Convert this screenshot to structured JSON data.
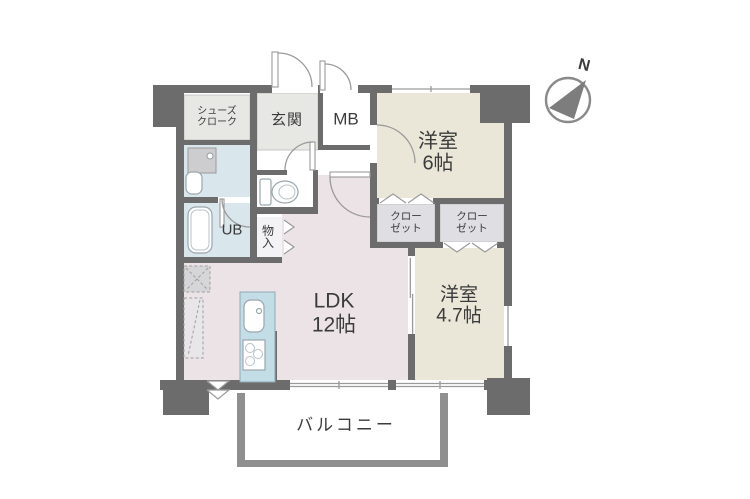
{
  "figure": {
    "kind": "apartment-floor-plan"
  },
  "compass": {
    "label": "N"
  },
  "rooms": {
    "shoes_closet": {
      "label": "シューズ\nクローク"
    },
    "entrance": {
      "label": "玄関"
    },
    "meter_box": {
      "label": "MB"
    },
    "bedroom_6": {
      "label": "洋室\n6帖"
    },
    "closet_a": {
      "label": "クロー\nゼット"
    },
    "closet_b": {
      "label": "クロー\nゼット"
    },
    "unit_bath": {
      "label": "UB"
    },
    "storage": {
      "label": "物\n入"
    },
    "ldk": {
      "label": "LDK\n12帖"
    },
    "bedroom_47": {
      "label": "洋室\n4.7帖"
    },
    "balcony": {
      "label": "バルコニー"
    }
  },
  "colors": {
    "background": "#ffffff",
    "wall": "#6c6c6c",
    "balcony_wall": "#8f8f8f",
    "room_western": "#eae7d8",
    "room_ldk": "#ece3e7",
    "room_wet": "#d9e6ec",
    "room_entrance": "#e7e7e4",
    "closet": "#dedee3",
    "kitchen_counter": "#c3dde6",
    "text": "#3b3b3b"
  }
}
